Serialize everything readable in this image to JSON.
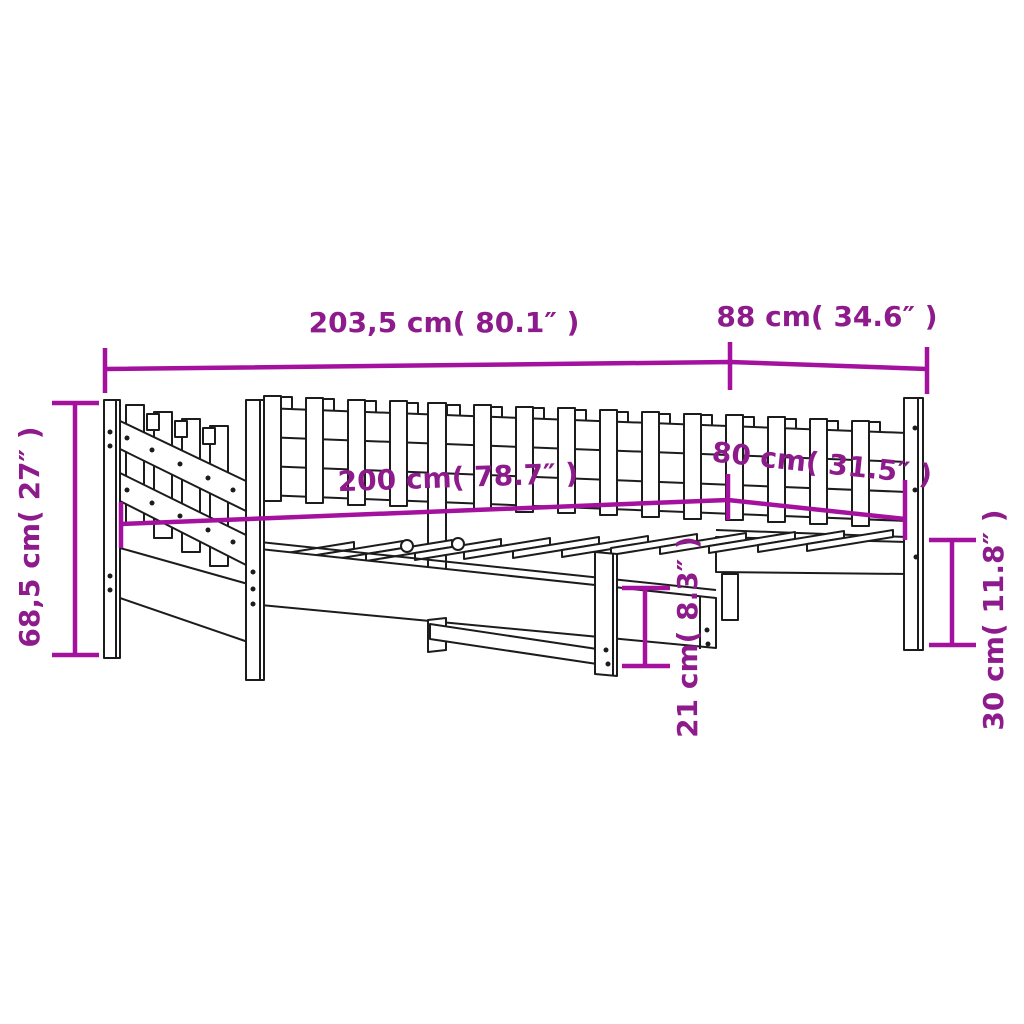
{
  "diagram": {
    "background": "#ffffff",
    "colors": {
      "dimension_line": "#a4119e",
      "dimension_text": "#8e1b8b",
      "artwork_line": "#1c1c1c"
    },
    "dimensions": {
      "length_total": "203,5 cm( 80.1″ )",
      "depth_total": "88 cm( 34.6″ )",
      "height_total": "68,5 cm( 27″ )",
      "length_sleeping": "200 cm( 78.7″ )",
      "width_sleeping": "80 cm( 31.5″ )",
      "clearance_under_frame": "21 cm( 8.3″ )",
      "height_frame_from_floor": "30 cm( 11.8″ )"
    }
  }
}
